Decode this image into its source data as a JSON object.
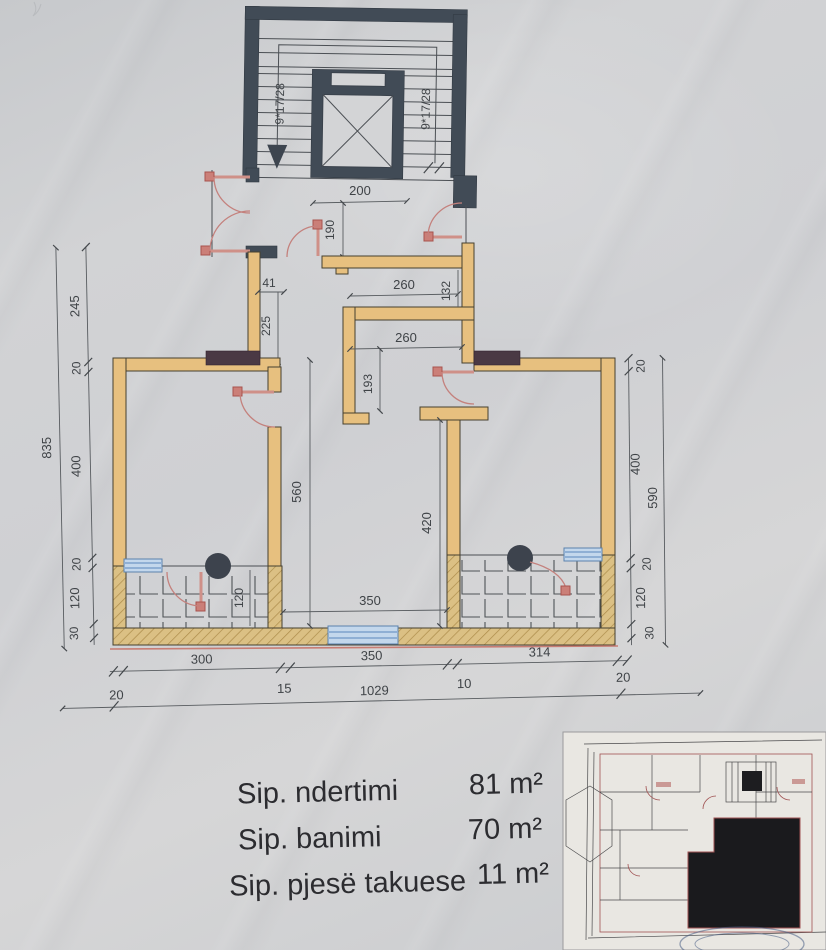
{
  "drawing": {
    "stairwell": {
      "flight_label_left": "9*17/28",
      "flight_label_right": "9*17/28"
    },
    "dims": {
      "top": {
        "w200": "200",
        "h190": "190"
      },
      "corridor": {
        "w41": "41",
        "h225": "225",
        "w260_upper": "260",
        "h132": "132",
        "w260_lower": "260",
        "h193": "193"
      },
      "left": {
        "total": "835",
        "chain": [
          "245",
          "20",
          "400",
          "20",
          "120",
          "30"
        ]
      },
      "right": {
        "total": "590",
        "chain": [
          "20",
          "400",
          "20",
          "120",
          "30"
        ]
      },
      "inner": {
        "h560": "560",
        "h420": "420",
        "w350": "350",
        "h120": "120"
      },
      "bottom": {
        "segments": [
          "300",
          "350",
          "314"
        ],
        "chain": [
          "20",
          "15",
          "1029",
          "10",
          "20"
        ]
      }
    }
  },
  "areas": {
    "rows": [
      {
        "label": "Sip. ndertimi",
        "value": "81 m²"
      },
      {
        "label": "Sip. banimi",
        "value": "70 m²"
      },
      {
        "label": "Sip. pjesë takuese",
        "value": "11 m²"
      }
    ]
  },
  "colors": {
    "wall_fill": "#e7c07f",
    "wall_hatch": "#dbc084",
    "stair_wall": "#414b56",
    "window_lintel": "#4a3944",
    "door_red": "#c4817d",
    "window_blue": "#c3d7ec",
    "facade_red": "#c87d74",
    "paper": "#d0d2d4",
    "dim_line": "#585c60"
  }
}
